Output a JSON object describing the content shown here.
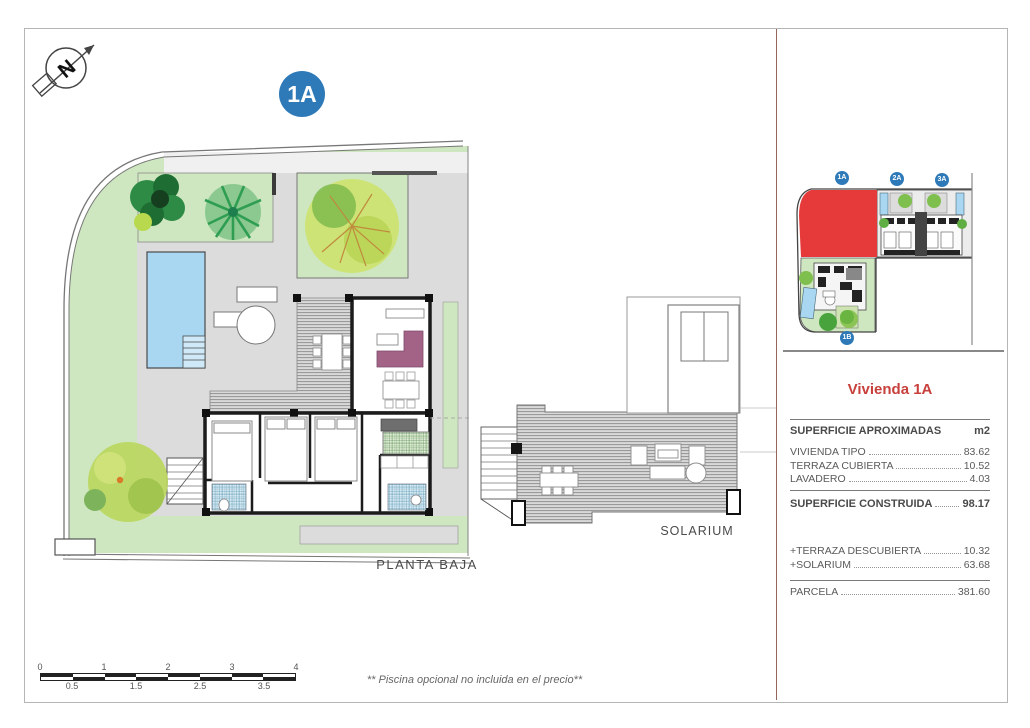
{
  "compass": {
    "letter": "N"
  },
  "plan_badge": "1A",
  "floor_plan": {
    "label": "PLANTA BAJA"
  },
  "solarium": {
    "label": "SOLARIUM"
  },
  "site_map": {
    "badges": [
      {
        "label": "1A"
      },
      {
        "label": "2A"
      },
      {
        "label": "3A"
      },
      {
        "label": "1B"
      }
    ],
    "highlighted_plot": "1A"
  },
  "panel": {
    "title": "Vivienda 1A",
    "table": {
      "header": {
        "label": "SUPERFICIE APROXIMADAS",
        "unit": "m2"
      },
      "rows": [
        {
          "label": "VIVIENDA TIPO",
          "value": "83.62"
        },
        {
          "label": "TERRAZA CUBIERTA",
          "value": "10.52"
        },
        {
          "label": "LAVADERO",
          "value": "4.03"
        }
      ],
      "total": {
        "label": "SUPERFICIE CONSTRUIDA",
        "value": "98.17"
      },
      "extras": [
        {
          "label": "+TERRAZA DESCUBIERTA",
          "value": "10.32"
        },
        {
          "label": "+SOLARIUM",
          "value": "63.68"
        }
      ],
      "parcel": {
        "label": "PARCELA",
        "value": "381.60"
      }
    }
  },
  "scalebar": {
    "top": [
      "0",
      "1",
      "2",
      "3",
      "4"
    ],
    "bottom": [
      "0.5",
      "1.5",
      "2.5",
      "3.5"
    ]
  },
  "footnote": "** Piscina opcional no incluida en el precio**",
  "colors": {
    "accent_red": "#c8403c",
    "badge_blue": "#2e7ab8",
    "plot_red": "#e63a3a",
    "pool_blue": "#a9d7f2",
    "garden_green": "#cfe7c0",
    "paving_gray": "#dcdcdc",
    "sofa_purple": "#a26387",
    "wall_black": "#1c1c1c"
  }
}
